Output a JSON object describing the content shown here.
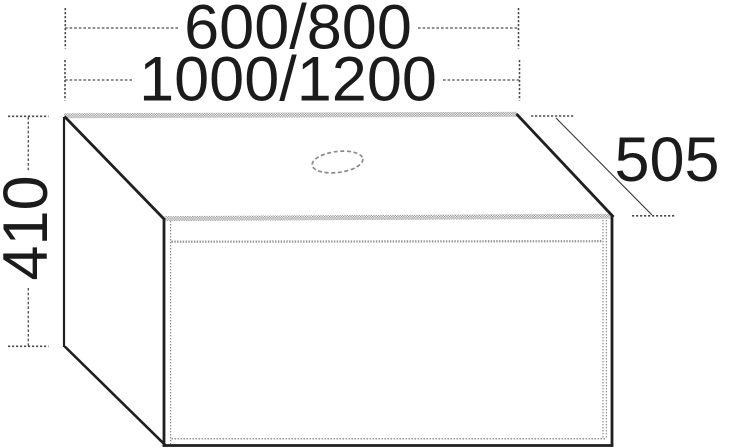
{
  "drawing": {
    "dimension_labels": {
      "width_options_small": "600/800",
      "width_options_large": "1000/1200",
      "depth": "505",
      "height": "410"
    },
    "colors": {
      "background": "#ffffff",
      "solid_edge": "#1f1f1f",
      "hatched_top_edge": "#909090",
      "hidden_line": "#8c8c8c",
      "dimension_line": "#4d4d4d",
      "label_text": "#1b1b1b"
    },
    "icons": {
      "tap_hole_icon": "dashed-oval-cutout"
    }
  }
}
